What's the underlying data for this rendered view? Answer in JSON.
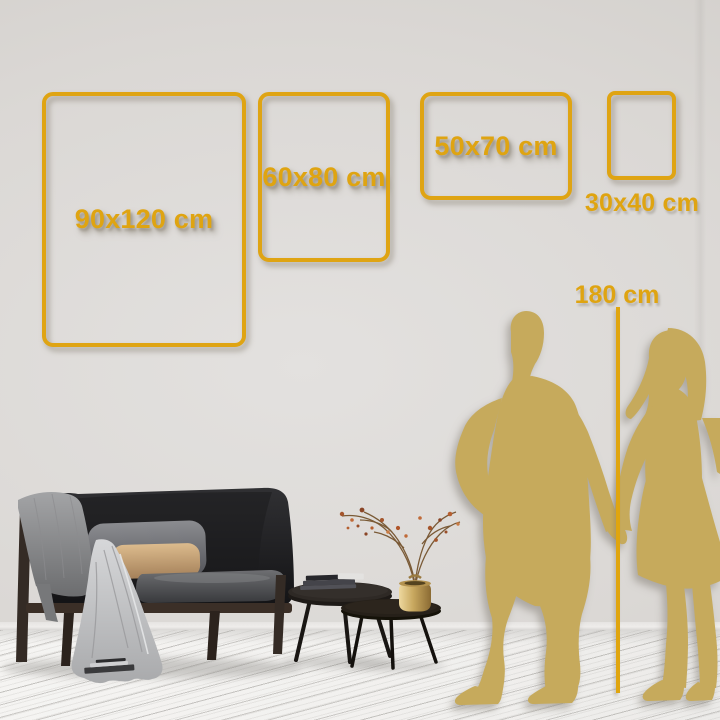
{
  "title": "Wall art size comparison guide",
  "colors": {
    "accent_gold": "#dfa413",
    "silhouette_gold": "#c6aa5c",
    "wall": "#dad7d4",
    "floor": "#f2f1ef"
  },
  "size_guide": {
    "unit": "cm",
    "frames": [
      {
        "label": "90x120 cm",
        "orientation": "portrait"
      },
      {
        "label": "60x80 cm",
        "orientation": "portrait"
      },
      {
        "label": "50x70 cm",
        "orientation": "landscape"
      },
      {
        "label": "30x40 cm",
        "orientation": "portrait"
      }
    ],
    "height_reference": {
      "label": "180 cm"
    }
  },
  "scene": {
    "objects": [
      "dark-sofa",
      "draped-throw-blanket",
      "gray-pillow",
      "tan-pillow",
      "nesting-coffee-tables",
      "stacked-books",
      "brass-vase-with-dried-branches",
      "man-silhouette",
      "woman-silhouette",
      "whitewashed-wood-floor"
    ]
  }
}
